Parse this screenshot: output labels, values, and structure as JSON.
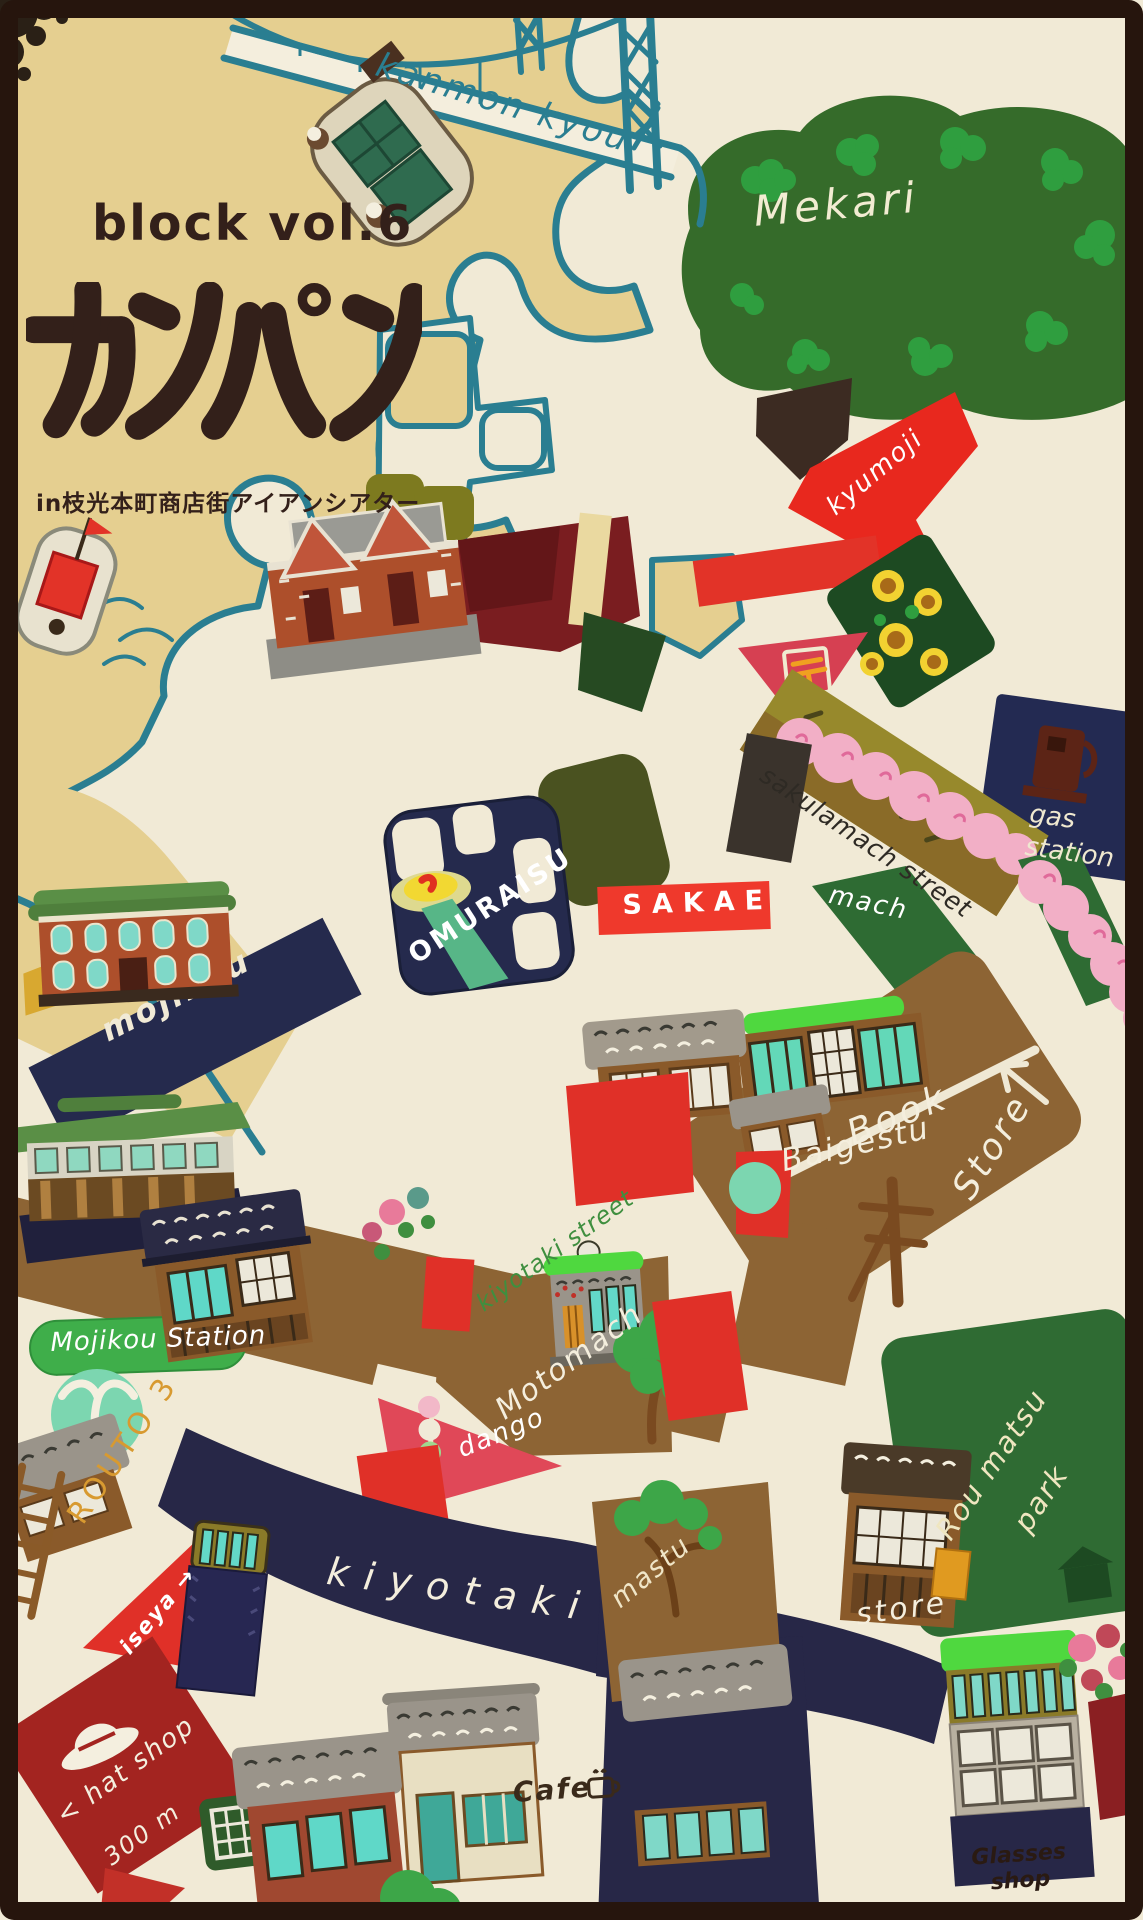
{
  "poster": {
    "series": "block vol.6",
    "title": "カンパン",
    "subtitle": "in枝光本町商店街アイアンシアター"
  },
  "labels": {
    "kanmon_kyou": "kanmon kyou",
    "mekari": "Mekari",
    "kyumoji": "kyumoji",
    "sakuramach_street": "sakulamach street",
    "gas_station": "gas station",
    "omuraisu": "OMURAISU",
    "sakae": "SAKAE",
    "mach": "mach",
    "mojikou_road": "mojikou",
    "book_word1": "Book",
    "book_word2": "Store",
    "baigestu": "Baigestu",
    "mojikou_station": "Mojikou Station",
    "routo3": "ROUTO 3",
    "kiyotaki_street": "kiyotaki street",
    "motomach": "Motomach",
    "dango": "dango",
    "kiyotaki": "kiyotaki",
    "mastu": "mastu",
    "store": "store",
    "roumatsu_word1": "Rou matsu",
    "roumatsu_word2": "park",
    "iseya": "iseya",
    "iseya_arrow": "→",
    "hat_arrow": "<",
    "hat_shop": "hat shop",
    "hat_distance": "300 m",
    "cafe": "Cafe",
    "glasses_shop": "Glasses shop",
    "post_mark": "〒",
    "go_sign": "囲"
  },
  "colors": {
    "frame": "#26150d",
    "paper": "#f1ead6",
    "sea": "#e5cf90",
    "coast_teal": "#2a7e91",
    "ink": "#33201a",
    "red": "#e8281e",
    "crimson_post": "#d64052",
    "navy": "#272747",
    "park_green": "#2f6b33",
    "bright_green": "#4fd83f",
    "mint": "#7cd6b0",
    "teal_window": "#63d8c8",
    "olive_road": "#97892c",
    "brown_road": "#8d6434",
    "blossom_pink": "#f2afc6",
    "orange_route": "#d89a30",
    "maroon": "#7a1d20"
  }
}
